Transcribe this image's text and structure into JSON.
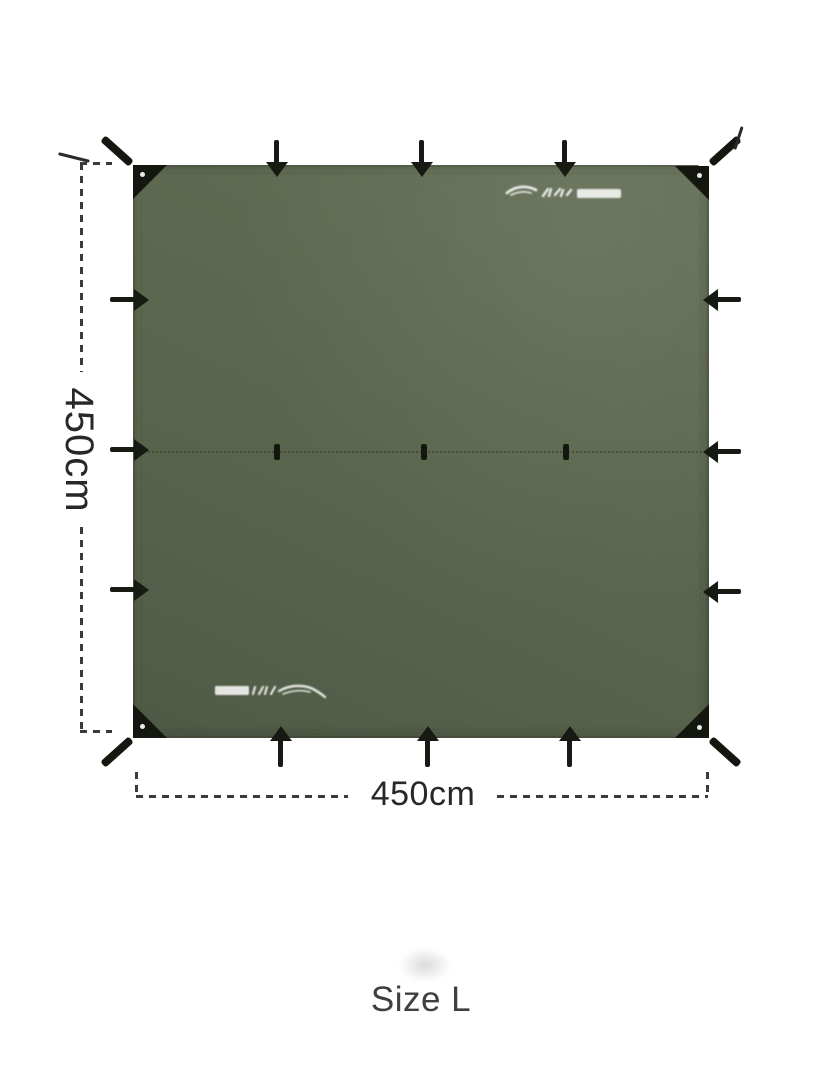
{
  "diagram": {
    "type": "product-dimension-diagram",
    "subject": "square camping tarp, top view",
    "dimensions": {
      "height_label": "450cm",
      "width_label": "450cm"
    },
    "size_label": "Size L",
    "tarp": {
      "fabric_color": "#5a654d",
      "hardware_color": "#15180f",
      "tie_out_points": {
        "corner_loops": 4,
        "top_edge_loops": 3,
        "bottom_edge_loops": 3,
        "left_edge_loops": 3,
        "right_edge_loops": 3,
        "center_seam_loops": 3
      },
      "brand_marks": 2,
      "brand_mark_color": "#ffffff"
    },
    "annotation": {
      "line_style": "dashed",
      "line_color": "#3a3a3a",
      "text_color": "#282828"
    },
    "background_color": "#ffffff"
  }
}
